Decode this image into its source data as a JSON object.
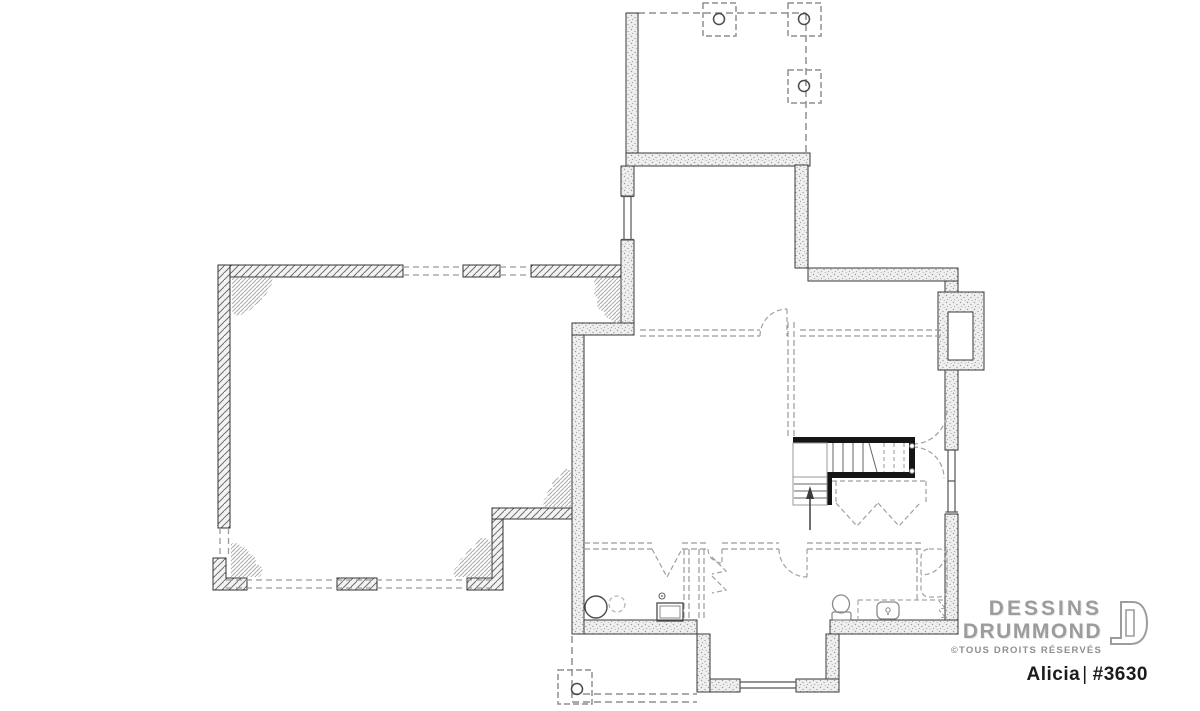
{
  "branding": {
    "line1": "DESSINS",
    "line2": "DRUMMOND",
    "copyright": "©TOUS DROITS RÉSERVÉS"
  },
  "plan": {
    "name": "Alicia",
    "separator": "|",
    "number": "#3630"
  },
  "drawing": {
    "type": "basement floor plan",
    "colors": {
      "wall_outline": "#3a3a3a",
      "wall_fill": "#efefef",
      "stair_wall": "#151515",
      "dashed_lines": "#9a9a9a",
      "hatch": "#6f6f6f",
      "background": "#ffffff",
      "brand_gray": "#9c9c9c",
      "title_black": "#1c1c1c"
    }
  }
}
